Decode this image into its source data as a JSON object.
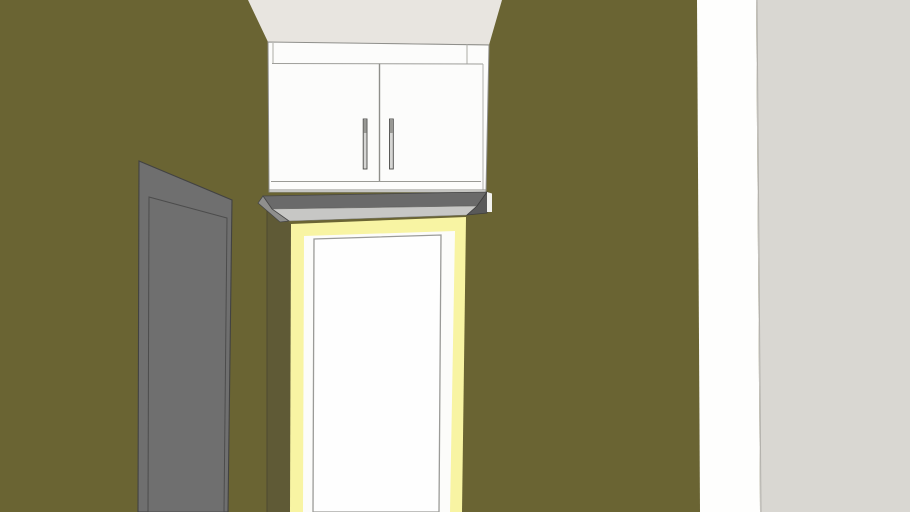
{
  "viewport": {
    "width": 910,
    "height": 512,
    "description": "3D model viewport: interior corner with olive-green walls, a white two-door wall cabinet mounted above a doorway with pale-yellow trim and white frame, a gray paneled door on the left wall, light ceiling above, and a white/gray wall section at far right"
  },
  "colors": {
    "wall_olive": "#6A6433",
    "jamb_shadow_olive": "#5F5A36",
    "ceiling": "#E8E5E0",
    "cabinet_white": "#FCFCFB",
    "door_trim_yellow": "#F8F4A3",
    "door_frame_white": "#FCFCFA",
    "door_panel_white": "#FEFEFE",
    "shelf_dark_gray": "#6A6A6A",
    "shelf_light_gray": "#C7C7C5",
    "left_door_gray": "#6F6F6F",
    "right_wall_white": "#FEFEFD",
    "far_right_wall_gray": "#D9D7D2",
    "handle_gray": "#D5D5D3",
    "outline_gray": "#8F8F8B"
  },
  "scene": {
    "shapes": [
      {
        "name": "wall-left-olive",
        "type": "polygon",
        "points": "0,0 697,0 700,512 0,512",
        "fill": "#6A6433"
      },
      {
        "name": "wall-right-white-strip",
        "type": "polygon",
        "points": "697,0 756,0 760,512 700,512",
        "fill": "#FEFEFD"
      },
      {
        "name": "wall-far-right-gray",
        "type": "polygon",
        "points": "756,0 910,0 910,512 760,512",
        "fill": "#D9D7D2"
      },
      {
        "name": "wall-corner-edge-line",
        "type": "line",
        "x1": 757,
        "y1": 0,
        "x2": 761,
        "y2": 512,
        "stroke": "#B3B1AC",
        "w": 1
      },
      {
        "name": "ceiling",
        "type": "polygon",
        "points": "248,0 502,0 489,45 268,42",
        "fill": "#E8E5E0"
      },
      {
        "name": "ceiling-edge-line",
        "type": "line",
        "x1": 268,
        "y1": 42.5,
        "x2": 489,
        "y2": 45,
        "stroke": "#A6A49A",
        "w": 1.2
      },
      {
        "name": "doorway-jamb-shadow",
        "type": "polygon",
        "points": "267,204 291,224 291,512 267,512",
        "fill": "#5F5A36"
      },
      {
        "name": "doorway-jamb-corner-line",
        "type": "line",
        "x1": 267,
        "y1": 205,
        "x2": 267,
        "y2": 512,
        "stroke": "#4E4930",
        "w": 1
      },
      {
        "name": "doorway-trim-yellow",
        "type": "polygon",
        "points": "291,224 466,217 462,512 290,512",
        "fill": "#F8F4A3"
      },
      {
        "name": "doorway-frame-white",
        "type": "polygon",
        "points": "304,236 455,231 450,512 303,512",
        "fill": "#FCFCFA"
      },
      {
        "name": "doorway-door-panel",
        "type": "polygon",
        "points": "314,239 441,235 439,512 313,512",
        "fill": "#FEFEFE",
        "stroke": "#9B9B98",
        "w": 1.3
      },
      {
        "name": "cabinet-body",
        "type": "polygon",
        "points": "268,42 489,45 486,192 269,192",
        "fill": "#FCFCFB",
        "stroke": "#8F8F8B",
        "w": 1
      },
      {
        "name": "cabinet-filler-line-left",
        "type": "line",
        "x1": 273,
        "y1": 43,
        "x2": 273,
        "y2": 63.5,
        "stroke": "#ABABA6",
        "w": 1
      },
      {
        "name": "cabinet-filler-line-right",
        "type": "line",
        "x1": 467,
        "y1": 44,
        "x2": 467,
        "y2": 63.5,
        "stroke": "#ABABA6",
        "w": 1
      },
      {
        "name": "cabinet-top-rail-line",
        "type": "line",
        "x1": 272,
        "y1": 63.5,
        "x2": 483,
        "y2": 64,
        "stroke": "#9E9E9A",
        "w": 1
      },
      {
        "name": "cabinet-door-divider-line",
        "type": "line",
        "x1": 379.5,
        "y1": 63.5,
        "x2": 379.5,
        "y2": 181.5,
        "stroke": "#8E8E8A",
        "w": 1.4
      },
      {
        "name": "cabinet-right-stile-line",
        "type": "line",
        "x1": 483,
        "y1": 64,
        "x2": 483,
        "y2": 190,
        "stroke": "#B1B1AC",
        "w": 1
      },
      {
        "name": "cabinet-doors-bottom-line",
        "type": "line",
        "x1": 271,
        "y1": 181.5,
        "x2": 481,
        "y2": 181.5,
        "stroke": "#9A9A95",
        "w": 1.1
      },
      {
        "name": "cabinet-carcass-bottom-line",
        "type": "line",
        "x1": 269,
        "y1": 190,
        "x2": 486,
        "y2": 190,
        "stroke": "#8E8E8A",
        "w": 1
      },
      {
        "name": "cabinet-handle-left",
        "type": "rect",
        "x": 363.2,
        "y": 119,
        "width": 3.8,
        "height": 50,
        "fill": "#D5D5D3",
        "stroke": "#4A4A48",
        "w": 0.9
      },
      {
        "name": "cabinet-handle-left-cap",
        "type": "rect",
        "x": 363.6,
        "y": 120,
        "width": 3,
        "height": 13,
        "fill": "#989894"
      },
      {
        "name": "cabinet-handle-right",
        "type": "rect",
        "x": 389.5,
        "y": 119,
        "width": 3.8,
        "height": 50,
        "fill": "#D5D5D3",
        "stroke": "#4A4A48",
        "w": 0.9
      },
      {
        "name": "cabinet-handle-right-cap",
        "type": "rect",
        "x": 389.9,
        "y": 120,
        "width": 3,
        "height": 13,
        "fill": "#989894"
      },
      {
        "name": "shelf-underside-dark",
        "type": "polygon",
        "points": "263,196 487,192 477,206 272,209",
        "fill": "#6A6A6A",
        "stroke": "#474747",
        "w": 0.8
      },
      {
        "name": "shelf-fascia-light",
        "type": "polygon",
        "points": "272,209 477,206 467,215 289,221",
        "fill": "#C7C7C5",
        "stroke": "#7E7E7A",
        "w": 0.6
      },
      {
        "name": "shelf-left-end-cap",
        "type": "polygon",
        "points": "263,196 272,209 289,221 280,222 258,203",
        "fill": "#8F8F8D",
        "stroke": "#474747",
        "w": 0.8
      },
      {
        "name": "shelf-right-end-cap",
        "type": "polygon",
        "points": "477,206 487,192 491,194 487,213 467,215",
        "fill": "#595959",
        "stroke": "#3E3E3E",
        "w": 0.8
      },
      {
        "name": "shelf-right-white-sliver",
        "type": "polygon",
        "points": "487,192 492,193.5 492,212 487,212",
        "fill": "#F2F2EF"
      },
      {
        "name": "left-door-gray",
        "type": "polygon",
        "points": "139,161 232,200 228,512 138,512",
        "fill": "#6F6F6F",
        "stroke": "#424242",
        "w": 1.1
      },
      {
        "name": "left-door-panel-outline",
        "type": "polygon",
        "points": "149,197 227,218 224,512 148,512",
        "fill": "none",
        "stroke": "#4C4C4C",
        "w": 1
      }
    ]
  }
}
